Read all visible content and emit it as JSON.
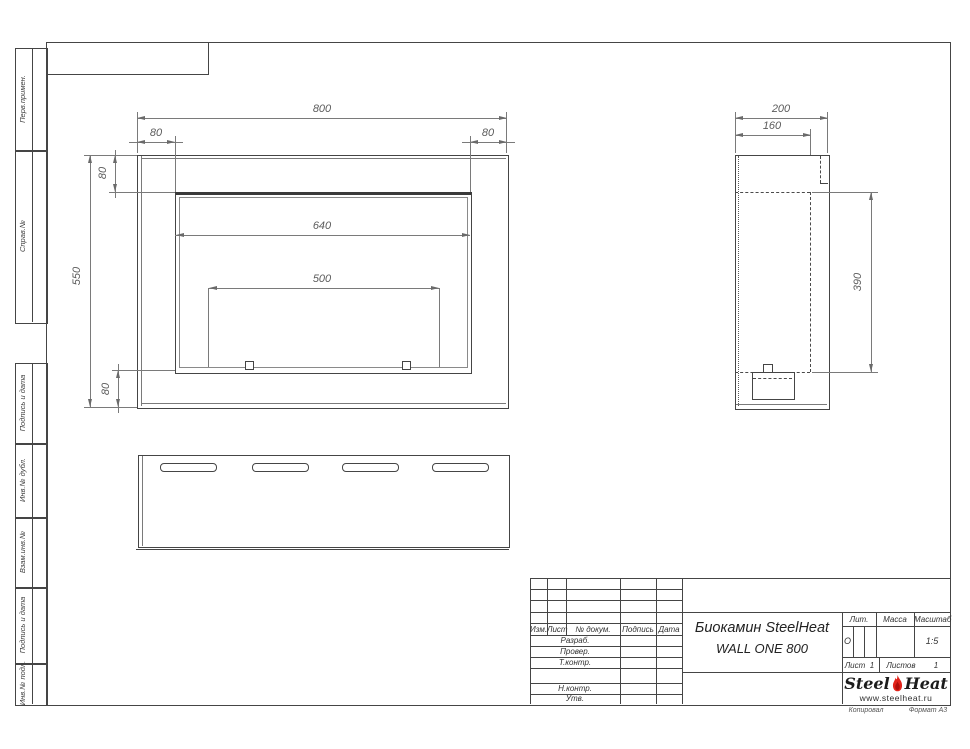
{
  "sheet": {
    "footer_copy": "Копировал",
    "footer_format": "Формат А3"
  },
  "margin_labels": {
    "perv_primen": "Перв.примен.",
    "sprav_no": "Справ.№",
    "podpis_data_1": "Подпись и дата",
    "inv_dubl": "Инв.№ дубл.",
    "vzam_inv": "Взам.инв.№",
    "podpis_data_2": "Подпись и дата",
    "inv_podl": "Инв.№ подл."
  },
  "dims": {
    "front": {
      "w_total": "800",
      "w_left": "80",
      "w_right": "80",
      "h_top": "80",
      "w_opening": "640",
      "w_burner": "500",
      "h_total": "550",
      "h_bottom": "80"
    },
    "side": {
      "d_total": "200",
      "d_inner": "160",
      "h_opening": "390"
    }
  },
  "title_block": {
    "rev_headers": {
      "izm": "Изм.",
      "list": "Лист",
      "doc": "№ докум.",
      "sign": "Подпись",
      "date": "Дата"
    },
    "rows": [
      "Разраб.",
      "Провер.",
      "Т.контр.",
      "Н.контр.",
      "Утв."
    ],
    "title_line1": "Биокамин SteelHeat",
    "title_line2": "WALL ONE 800",
    "lit_label": "Лит.",
    "lit_value": "О",
    "mass_label": "Масса",
    "scale_label": "Масштаб",
    "scale_value": "1:5",
    "sheet_label": "Лист",
    "sheet_value": "1",
    "sheets_label": "Листов",
    "sheets_value": "1",
    "logo_steel": "Steel",
    "logo_heat": "Heat",
    "logo_url": "www.steelheat.ru"
  },
  "colors": {
    "line": "#454545",
    "dim": "#6a6a6a",
    "flame": "#e2231a"
  }
}
